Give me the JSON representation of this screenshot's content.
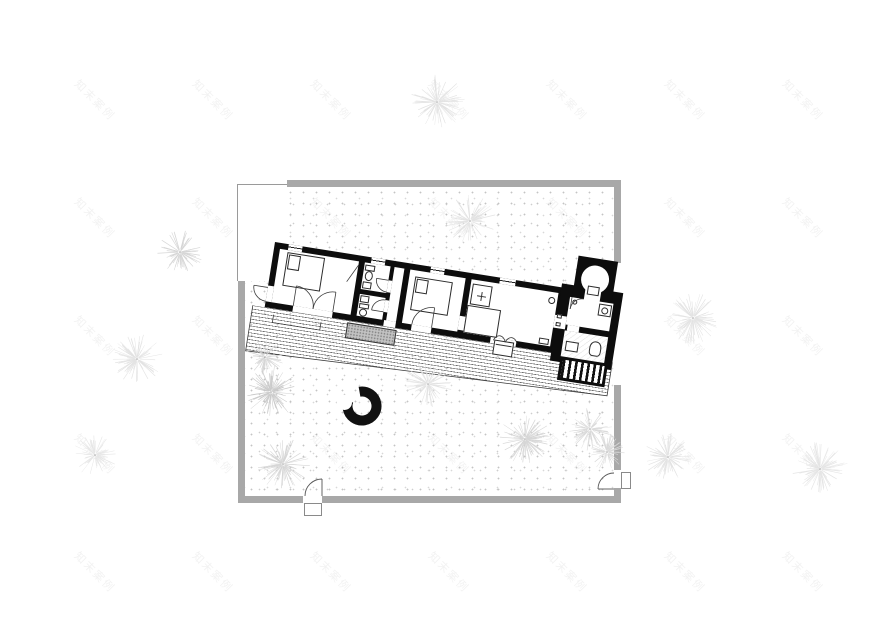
{
  "watermark": {
    "text": "知末案例",
    "color": "rgba(70,70,70,0.07)",
    "cols": [
      95,
      213,
      331,
      449,
      567,
      685,
      803
    ],
    "rows": [
      100,
      218,
      336,
      454,
      572
    ]
  },
  "site": {
    "boundary_wall_color": "#a8a8a8",
    "ground_dot_color": "#c6c6c6"
  },
  "plan": {
    "wall_color": "#0d0d0d",
    "thin_line_color": "#3a3a3a",
    "rotation_deg": 9
  },
  "firepit": {
    "cx": 362,
    "cy": 406,
    "outer_r": 19.5,
    "ring_color": "#111111"
  },
  "trees": [
    {
      "x": 437,
      "y": 102,
      "r": 28,
      "shade": "#e2e2e2"
    },
    {
      "x": 470,
      "y": 221,
      "r": 26,
      "shade": "#e2e2e2"
    },
    {
      "x": 180,
      "y": 252,
      "r": 23,
      "shade": "#d4d4d4"
    },
    {
      "x": 137,
      "y": 359,
      "r": 26,
      "shade": "#e2e2e2"
    },
    {
      "x": 95,
      "y": 455,
      "r": 22,
      "shade": "#e6e6e6"
    },
    {
      "x": 265,
      "y": 357,
      "r": 19,
      "shade": "#d4d4d4"
    },
    {
      "x": 271,
      "y": 392,
      "r": 27,
      "shade": "#c8c8c8"
    },
    {
      "x": 283,
      "y": 464,
      "r": 27,
      "shade": "#d4d4d4"
    },
    {
      "x": 428,
      "y": 384,
      "r": 24,
      "shade": "#e2e2e2"
    },
    {
      "x": 525,
      "y": 439,
      "r": 26,
      "shade": "#d4d4d4"
    },
    {
      "x": 590,
      "y": 429,
      "r": 22,
      "shade": "#d8d8d8"
    },
    {
      "x": 607,
      "y": 452,
      "r": 19,
      "shade": "#d8d8d8"
    },
    {
      "x": 668,
      "y": 457,
      "r": 24,
      "shade": "#e2e2e2"
    },
    {
      "x": 693,
      "y": 318,
      "r": 26,
      "shade": "#e2e2e2"
    },
    {
      "x": 820,
      "y": 469,
      "r": 28,
      "shade": "#e4e4e4"
    }
  ]
}
